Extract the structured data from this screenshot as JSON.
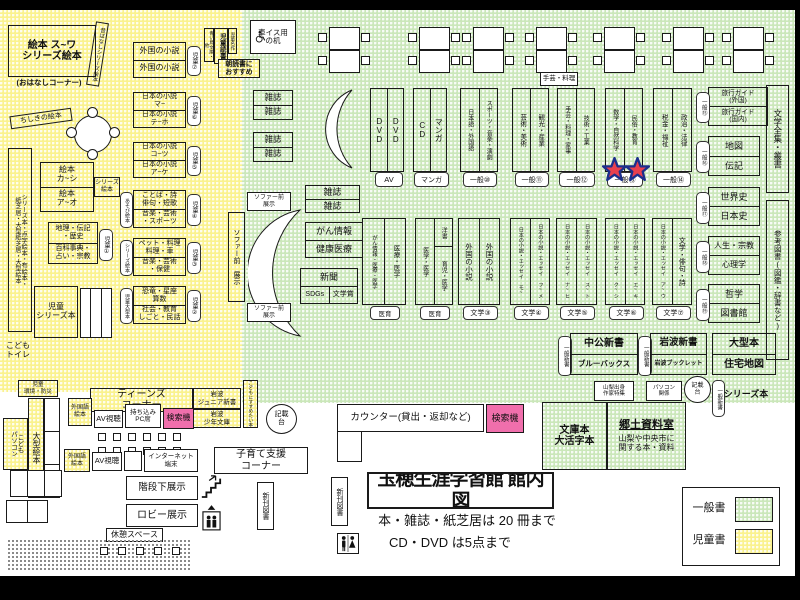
{
  "title": {
    "main": "玉穂生涯学習館 館内図",
    "rule1": "本・雑誌・紙芝居は 20 冊まで",
    "rule2": "CD・DVD は5点まで"
  },
  "legend": {
    "general": "一般書",
    "children": "児童書",
    "general_color": "#CBE7BA",
    "children_color": "#FAF28F"
  },
  "kidsArea": {
    "ehonMain": "絵本 ス~ワ\nシリーズ絵本",
    "ohanashi": "(おはなしコーナー)",
    "mukashibanashi": "昔ばなしシリーズ絵本",
    "chishiki": "ちしきの絵本",
    "leftStrip": "シリーズ本・点字絵本・布絵本・\n紙芝居・大型紙芝居・大型絵本",
    "ehonKaShi": "絵本\nカ~シ",
    "ehonAO": "絵本\nア~オ",
    "seriesEhon": "シリーズ\n絵本",
    "chiri": "地理・伝記\n・歴史",
    "hyakka": "百科事典・\n占い・宗教",
    "tab1": "児童①",
    "jidoSeries": "児童\nシリーズ本",
    "kodomoToilet": "こども\nトイレ",
    "kankyoBosai": "児童\n環境・防災",
    "aoitori": "青い鳥文庫・他",
    "jidoDokusho": "児童読書",
    "meisaku": "児童名作",
    "asadoku": "朝読書に\nおすすめ",
    "ogataEhon": "大型絵本",
    "kodomoPC": "こども\nパソコン",
    "susume": "こどもにすすめたい本",
    "shelves": [
      {
        "top": "外国の小説",
        "bottom": "外国の小説",
        "tab": "児童⑦"
      },
      {
        "top": "日本の小説\nマ~",
        "bottom": "日本の小説\nテ~ホ",
        "tab": "児童⑥"
      },
      {
        "top": "日本の小説\nコ~ツ",
        "bottom": "日本の小説\nア~ケ",
        "tab": "児童⑤"
      },
      {
        "top": "ことば・詩\n俳句・短歌",
        "bottom": "音楽・芸術\n・スポーツ",
        "tab": "児童④",
        "side": "あそび絵本"
      },
      {
        "top": "ペット・料理\n料理・車",
        "bottom": "音楽・芸術\n・保健",
        "tab": "児童③",
        "side": "シリーズ絵本"
      },
      {
        "top": "恐竜・星座\n算数",
        "bottom": "社会・教育\nしごと・民話",
        "tab": "児童②",
        "side": "児童大型本"
      }
    ]
  },
  "generalArea": {
    "kurumaisu": "車イス用\nの机",
    "zasshi": "雑誌",
    "shugei": "手芸・料理",
    "topShelves": [
      {
        "left": "DVD",
        "right": "DVD",
        "label": "AV"
      },
      {
        "left": "CD",
        "right": "マンガ",
        "label": "マンガ"
      },
      {
        "left": "日本語・外国語",
        "right": "スポーツ・音楽・演劇",
        "label": "一般⑩"
      },
      {
        "left": "芸術・美術",
        "right": "観光・産業",
        "label": "一般⑪"
      },
      {
        "left": "手芸・料理・家事",
        "right": "技術・工業",
        "label": "一般⑫"
      },
      {
        "left": "数学・自然科学",
        "right": "民俗・教育",
        "label": "一般⑬"
      },
      {
        "left": "税金・福祉",
        "right": "政治・法律",
        "label": "一般⑭"
      }
    ],
    "rightStacks": [
      {
        "top": "旅行ガイド\n(外国)",
        "bottom": "旅行ガイド\n(国内)",
        "tab": "一般⑮"
      },
      {
        "top": "地図",
        "bottom": "伝記",
        "tab": "一般⑯"
      },
      {
        "top": "世界史",
        "bottom": "日本史",
        "tab": "一般⑰"
      },
      {
        "top": "人生・宗教",
        "bottom": "心理学",
        "tab": "一般⑱"
      },
      {
        "top": "哲学",
        "bottom": "図書館",
        "tab": "一般⑲"
      }
    ],
    "bungakuZenshu": "文学全集・叢書",
    "sankoTosho": "参考図書(図鑑・辞書など)",
    "sofaBig": "ソファー前 展示",
    "sofaSmall": "ソファー前\n展示",
    "ganInfo": "がん情報",
    "kenkoIryo": "健康医療",
    "shinbun": "新聞",
    "sdgs": "SDGs",
    "bungakuSho": "文学賞",
    "midShelves": [
      {
        "left": "がん情報・医療・医学",
        "right": "医療・医学",
        "label": "医育"
      },
      {
        "left": "医学・医学",
        "rightTop": "洋書",
        "rightBottom": "育児・医学",
        "label": "医育"
      },
      {
        "left": "外国の小説",
        "right": "外国の小説",
        "label": "文学③"
      },
      {
        "left": "日本の小説・エッセイ モ~",
        "right": "日本の小説・エッセイ フ~メ",
        "label": "文学④"
      },
      {
        "left": "日本の小説・エッセイ ナ~ヒ",
        "right": "日本の小説・エッセイ ス~ト",
        "label": "文学⑤"
      },
      {
        "left": "日本の小説・エッセイ ク~シ",
        "right": "日本の小説・エッセイ エ~キ",
        "label": "文学⑥"
      },
      {
        "left": "日本の小説・エッセイ ア~ウ",
        "right": "文学・俳句・詩",
        "label": "文学⑦"
      }
    ],
    "ippanShinsho": "一般新書",
    "shinsho": [
      {
        "top": "中公新書",
        "bottom": "ブルーバックス"
      },
      {
        "top": "岩波新書",
        "bottom": "岩波ブックレット"
      },
      {
        "top": "大型本",
        "bottom": "住宅地図"
      }
    ],
    "yamanashi": "山梨出身\n作家特集",
    "pasokonKankei": "パソコン\n関係",
    "kisaidai": "記載\n台",
    "seriesBon": "シリーズ本",
    "bunkobon": "文庫本\n大活字本",
    "kyodoTitle": "郷土資料室",
    "kyodoDesc": "山梨や中央市に\n関する本・資料",
    "counter": "カウンター(貸出・返却など)",
    "kensakuki": "検索機"
  },
  "services": {
    "teens": "ティーンズ\nコーナー",
    "gaikokugoEhon": "外国語\n絵本",
    "avShicho": "AV視聴",
    "mochikomiPC": "持ち込み\nPC席",
    "kensakuki": "検索機",
    "iwanamiJr": "岩波\nジュニア新書",
    "iwanamiShonen": "岩波\n少年文庫",
    "internet": "インターネット\n端末",
    "kosodate": "子育て支援\nコーナー",
    "kaidanShita": "階段下展示",
    "lobby": "ロビー展示",
    "kyukei": "休憩スペース",
    "shinkan": "新刊図書"
  }
}
